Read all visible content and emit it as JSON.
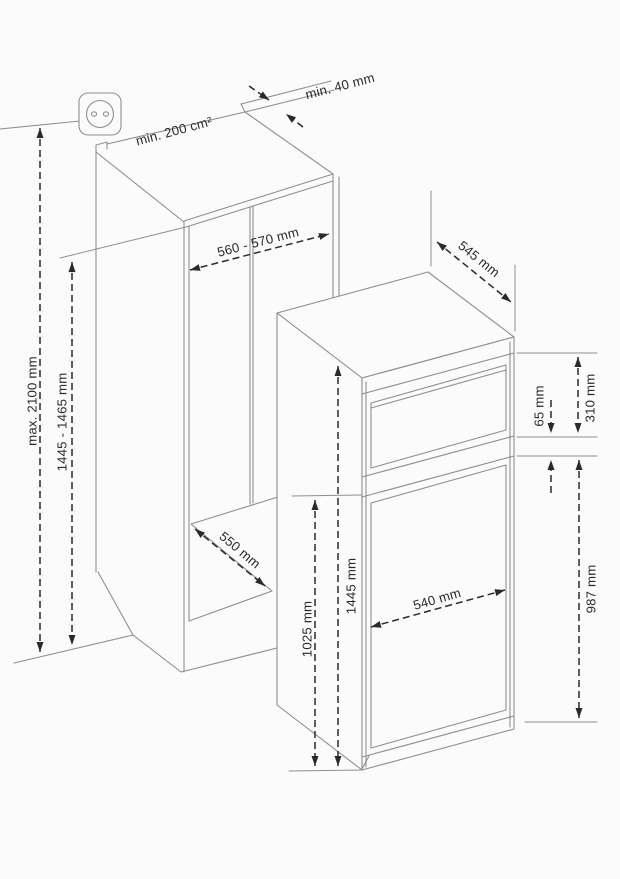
{
  "figure": {
    "background": "#fbfbfb",
    "object_line_color": "#8f8f8f",
    "dimension_color": "#2a2a2a",
    "niche": {
      "vent_area": "min. 200 cm²",
      "top_rear_gap": "min. 40 mm",
      "width": "560 - 570 mm",
      "depth": "550 mm",
      "max_height": "max. 2100 mm",
      "height": "1445 - 1465 mm"
    },
    "appliance": {
      "depth": "545 mm",
      "upper_door_height": "310 mm",
      "gap_height": "65 mm",
      "lower_part_height": "987 mm",
      "total_height": "1445 mm",
      "lower_door_top_height": "1025 mm",
      "width": "540 mm"
    },
    "icons": {
      "socket": "power-socket-icon"
    }
  }
}
